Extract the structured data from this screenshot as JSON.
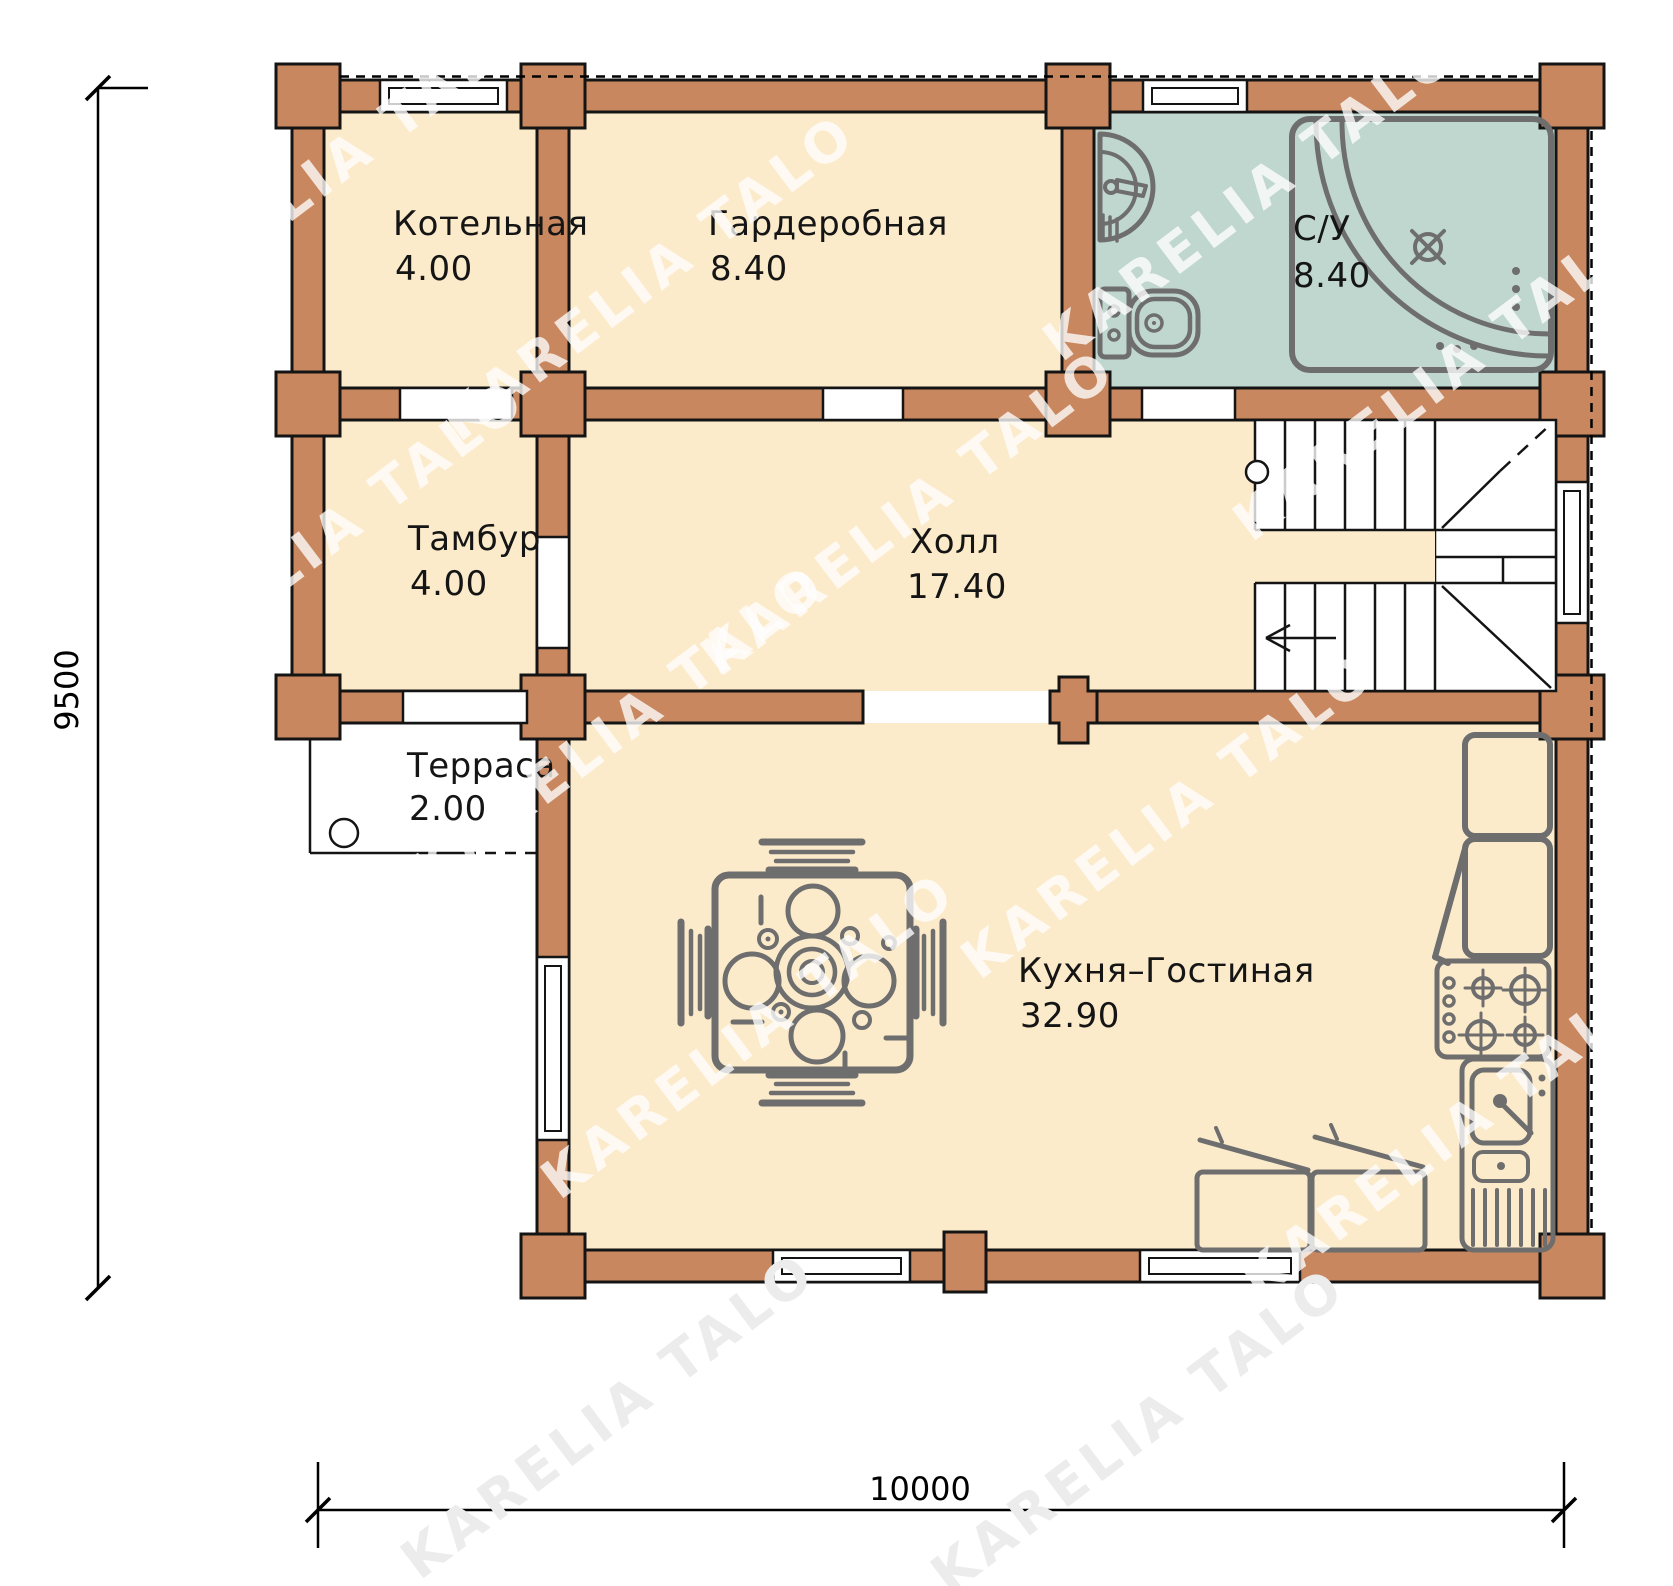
{
  "watermark": {
    "text": "KARELIA TALO"
  },
  "colors": {
    "wall": "#C8875E",
    "outline": "#141414",
    "floor": "#FCEBCB",
    "bath": "#C0D7D0",
    "fixture": "#6E6E6E"
  },
  "plan": {
    "rooms": [
      {
        "id": "boiler",
        "label": "Котельная",
        "area": "4.00"
      },
      {
        "id": "wardrobe",
        "label": "Гардеробная",
        "area": "8.40"
      },
      {
        "id": "bathroom",
        "label": "С/У",
        "area": "8.40"
      },
      {
        "id": "vestibule",
        "label": "Тамбур",
        "area": "4.00"
      },
      {
        "id": "hall",
        "label": "Холл",
        "area": "17.40"
      },
      {
        "id": "terrace",
        "label": "Терраса",
        "area": "2.00"
      },
      {
        "id": "kitchen",
        "label": "Кухня–Гостиная",
        "area": "32.90"
      }
    ],
    "dimensions": {
      "height": "9500",
      "width": "10000"
    }
  }
}
